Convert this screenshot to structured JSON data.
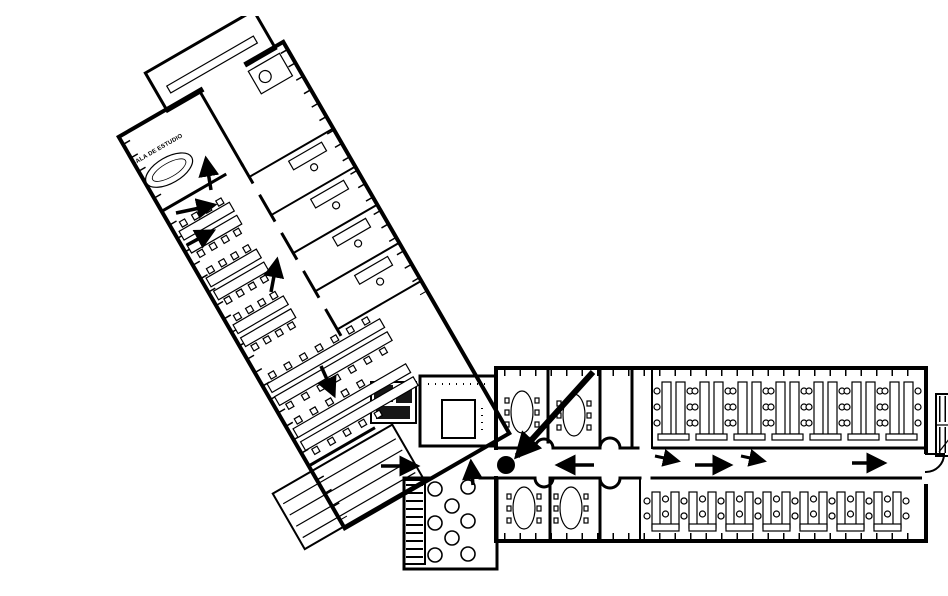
{
  "canvas": {
    "width": 948,
    "height": 564,
    "background": "#ffffff",
    "ink": "#000000"
  },
  "plan": {
    "room_label": "SALA DE ESTUDIO",
    "route": {
      "color": "#000000",
      "start_dot": {
        "x": 466,
        "y": 449,
        "r": 9
      },
      "big_arrow": {
        "x1": 553,
        "y1": 356,
        "x2": 477,
        "y2": 440,
        "width": 6
      },
      "arrows": [
        {
          "x1": 171,
          "y1": 174,
          "x2": 166,
          "y2": 143,
          "width": 3.5
        },
        {
          "x1": 136,
          "y1": 197,
          "x2": 174,
          "y2": 189,
          "width": 3.5
        },
        {
          "x1": 147,
          "y1": 229,
          "x2": 173,
          "y2": 215,
          "width": 3.5
        },
        {
          "x1": 231,
          "y1": 276,
          "x2": 237,
          "y2": 244,
          "width": 3.5
        },
        {
          "x1": 281,
          "y1": 350,
          "x2": 294,
          "y2": 379,
          "width": 3.5
        },
        {
          "x1": 341,
          "y1": 450,
          "x2": 377,
          "y2": 450,
          "width": 3.5
        },
        {
          "x1": 433,
          "y1": 469,
          "x2": 431,
          "y2": 446,
          "width": 3.5
        },
        {
          "x1": 554,
          "y1": 449,
          "x2": 518,
          "y2": 449,
          "width": 3.5
        },
        {
          "x1": 615,
          "y1": 440,
          "x2": 638,
          "y2": 445,
          "width": 3
        },
        {
          "x1": 655,
          "y1": 449,
          "x2": 690,
          "y2": 449,
          "width": 3.5
        },
        {
          "x1": 701,
          "y1": 440,
          "x2": 724,
          "y2": 445,
          "width": 3
        },
        {
          "x1": 812,
          "y1": 447,
          "x2": 844,
          "y2": 447,
          "width": 3.5
        }
      ]
    },
    "lobby_tables": [
      {
        "cx": 395,
        "cy": 473
      },
      {
        "cx": 428,
        "cy": 471
      },
      {
        "cx": 412,
        "cy": 490
      },
      {
        "cx": 395,
        "cy": 507
      },
      {
        "cx": 428,
        "cy": 505
      },
      {
        "cx": 412,
        "cy": 522
      },
      {
        "cx": 395,
        "cy": 539
      },
      {
        "cx": 428,
        "cy": 538
      }
    ],
    "table_radius": 7
  }
}
